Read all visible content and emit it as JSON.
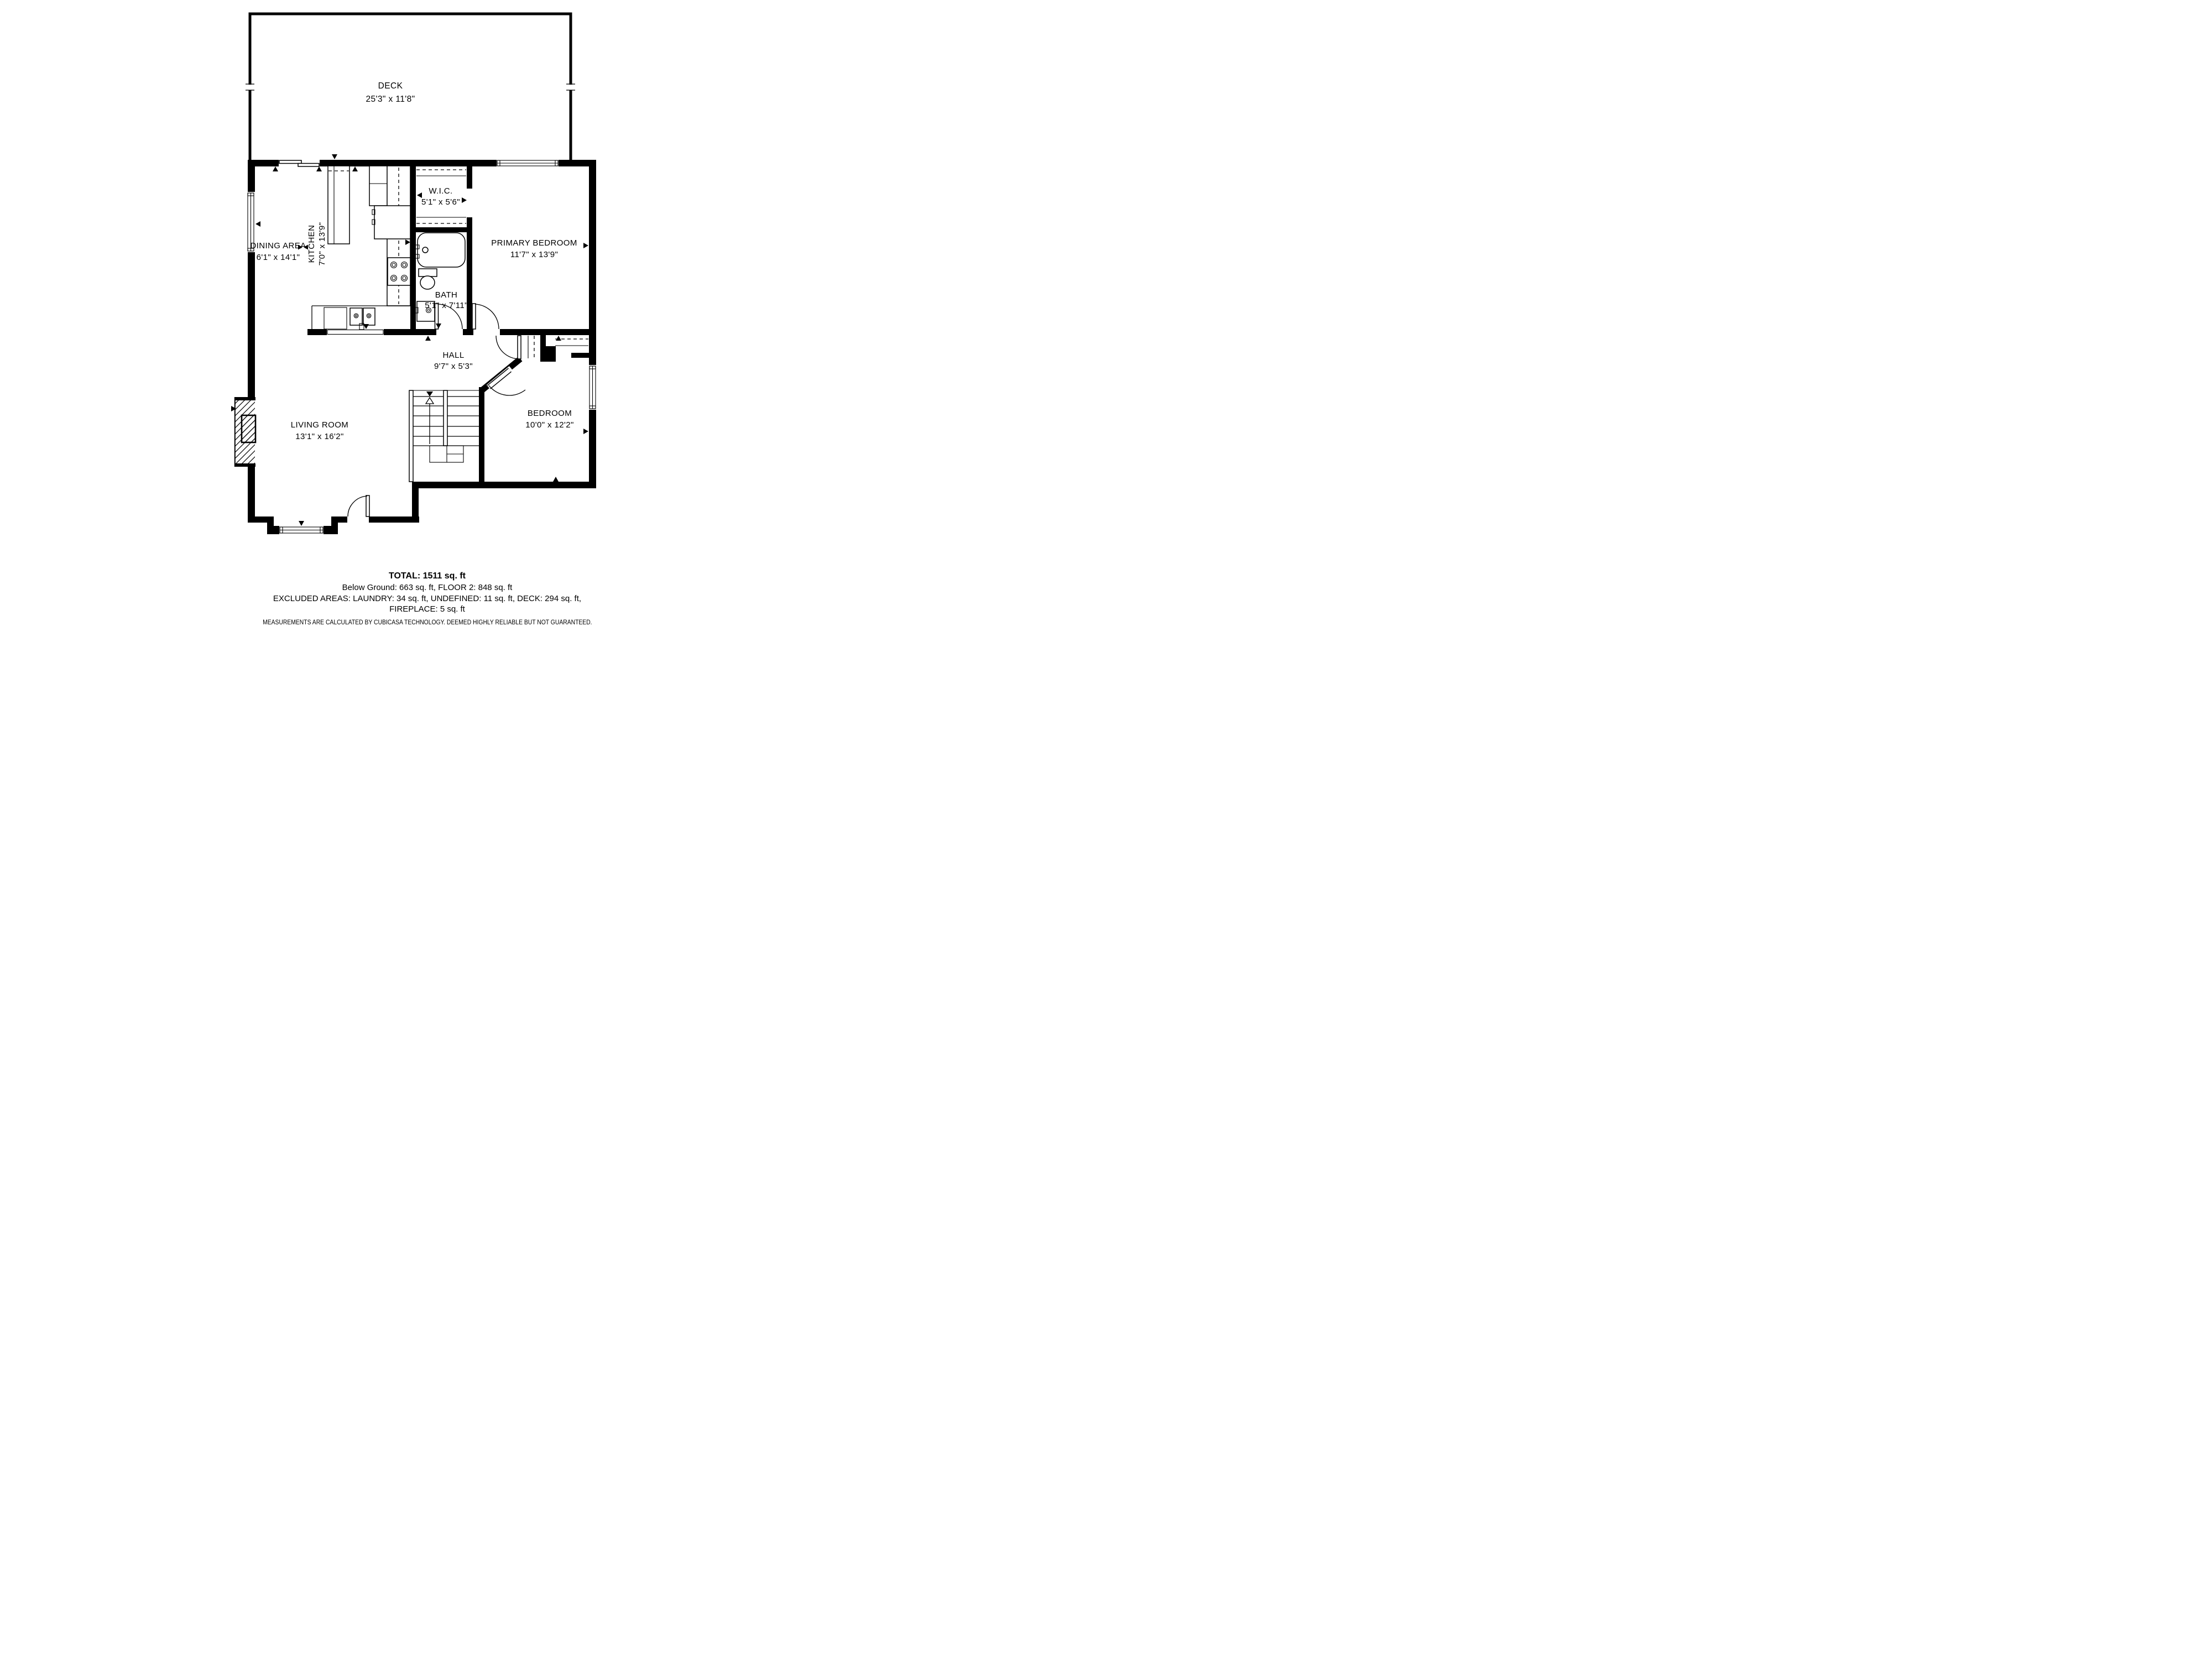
{
  "floorplan": {
    "deck": {
      "name": "DECK",
      "dims": "25'3\" x 11'8\""
    },
    "rooms": [
      {
        "name": "DINING AREA",
        "dims": "6'1\" x 14'1\""
      },
      {
        "name": "KITCHEN",
        "dims": "7'0\" x 13'9\""
      },
      {
        "name": "W.I.C.",
        "dims": "5'1\" x 5'6\""
      },
      {
        "name": "PRIMARY BEDROOM",
        "dims": "11'7\" x 13'9\""
      },
      {
        "name": "BATH",
        "dims": "5'1\" x 7'11\""
      },
      {
        "name": "HALL",
        "dims": "9'7\" x 5'3\""
      },
      {
        "name": "LIVING ROOM",
        "dims": "13'1\" x 16'2\""
      },
      {
        "name": "BEDROOM",
        "dims": "10'0\" x 12'2\""
      }
    ],
    "summary": {
      "total": "TOTAL: 1511 sq. ft",
      "floors": "Below Ground: 663 sq. ft, FLOOR 2: 848 sq. ft",
      "excluded": "EXCLUDED AREAS: LAUNDRY: 34 sq. ft, UNDEFINED: 11 sq. ft, DECK: 294 sq. ft,",
      "excluded2": "FIREPLACE: 5 sq. ft",
      "disclaimer": "MEASUREMENTS ARE CALCULATED BY CUBICASA TECHNOLOGY. DEEMED HIGHLY RELIABLE BUT NOT GUARANTEED."
    },
    "colors": {
      "walls": "#000000",
      "background": "#ffffff"
    }
  }
}
